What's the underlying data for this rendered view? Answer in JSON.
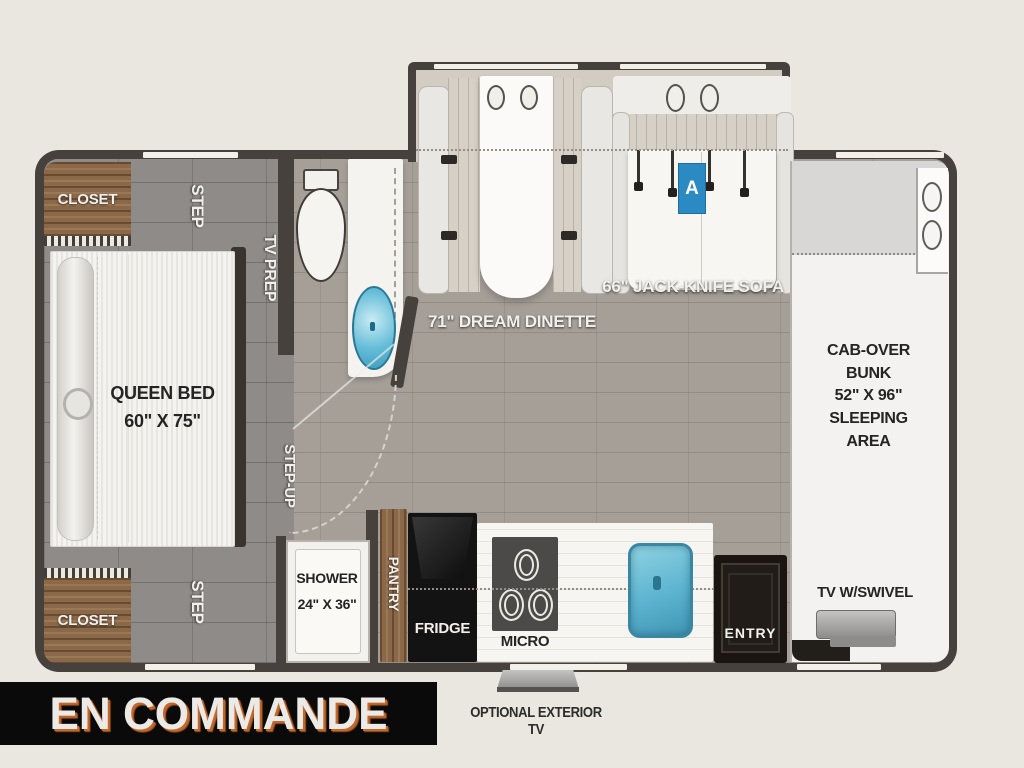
{
  "plan": {
    "labels": {
      "closet_top": "CLOSET",
      "closet_bottom": "CLOSET",
      "step_top": "STEP",
      "step_bottom": "STEP",
      "tv_prep": "TV PREP",
      "step_up": "STEP-UP",
      "queen_bed": "QUEEN BED\n60\" X 75\"",
      "shower": "SHOWER\n24\" X 36\"",
      "pantry": "PANTRY",
      "fridge": "FRIDGE",
      "micro": "MICRO",
      "entry": "ENTRY",
      "dinette": "71\" DREAM DINETTE",
      "sofa": "66\" JACK-KNIFE SOFA",
      "sofa_badge": "A",
      "cab_over": "CAB-OVER\nBUNK\n52\" X 96\"\nSLEEPING\nAREA",
      "tv_swivel": "TV W/SWIVEL"
    }
  },
  "footer": {
    "status": "EN COMMANDE",
    "optional_tv": "OPTIONAL EXTERIOR TV"
  },
  "colors": {
    "background": "#eae7e1",
    "wall": "#47413e",
    "banner_bg": "#0a0a0a",
    "banner_accent_orange": "#c4672a",
    "badge_blue": "#2b8ac2",
    "sink_blue": "#64bcd8",
    "closet_wood": "#8a6848"
  }
}
